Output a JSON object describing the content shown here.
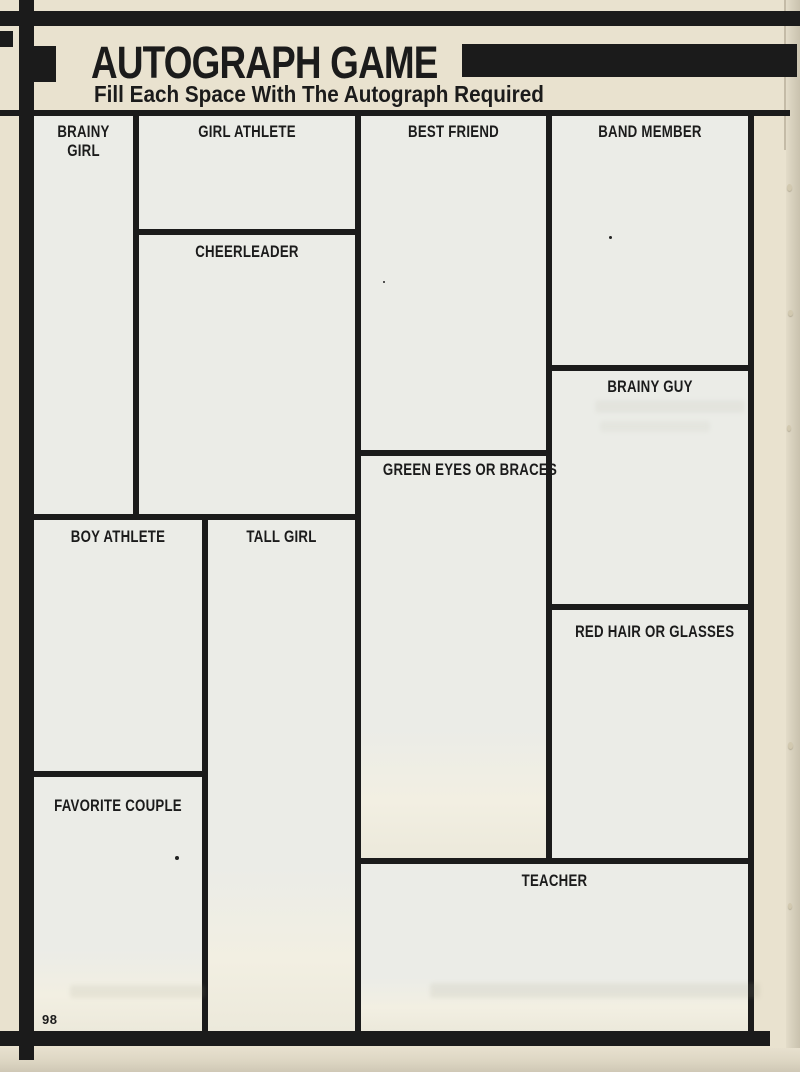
{
  "page": {
    "title": "AUTOGRAPH GAME",
    "subtitle": "Fill Each Space With The Autograph Required",
    "page_number": "98"
  },
  "colors": {
    "ink": "#1b1b1b",
    "paper": "#e9e2cf",
    "box_fill": "#ebece7"
  },
  "boxes": [
    {
      "id": "brainy-girl",
      "label": "BRAINY GIRL"
    },
    {
      "id": "girl-athlete",
      "label": "GIRL ATHLETE"
    },
    {
      "id": "cheerleader",
      "label": "CHEERLEADER"
    },
    {
      "id": "best-friend",
      "label": "BEST FRIEND"
    },
    {
      "id": "band-member",
      "label": "BAND MEMBER"
    },
    {
      "id": "brainy-guy",
      "label": "BRAINY GUY"
    },
    {
      "id": "green-eyes-or-braces",
      "label": "GREEN EYES OR BRACES"
    },
    {
      "id": "red-hair-or-glasses",
      "label": "RED HAIR OR GLASSES"
    },
    {
      "id": "boy-athlete",
      "label": "BOY ATHLETE"
    },
    {
      "id": "tall-girl",
      "label": "TALL GIRL"
    },
    {
      "id": "favorite-couple",
      "label": "FAVORITE COUPLE"
    },
    {
      "id": "teacher",
      "label": "TEACHER"
    }
  ]
}
